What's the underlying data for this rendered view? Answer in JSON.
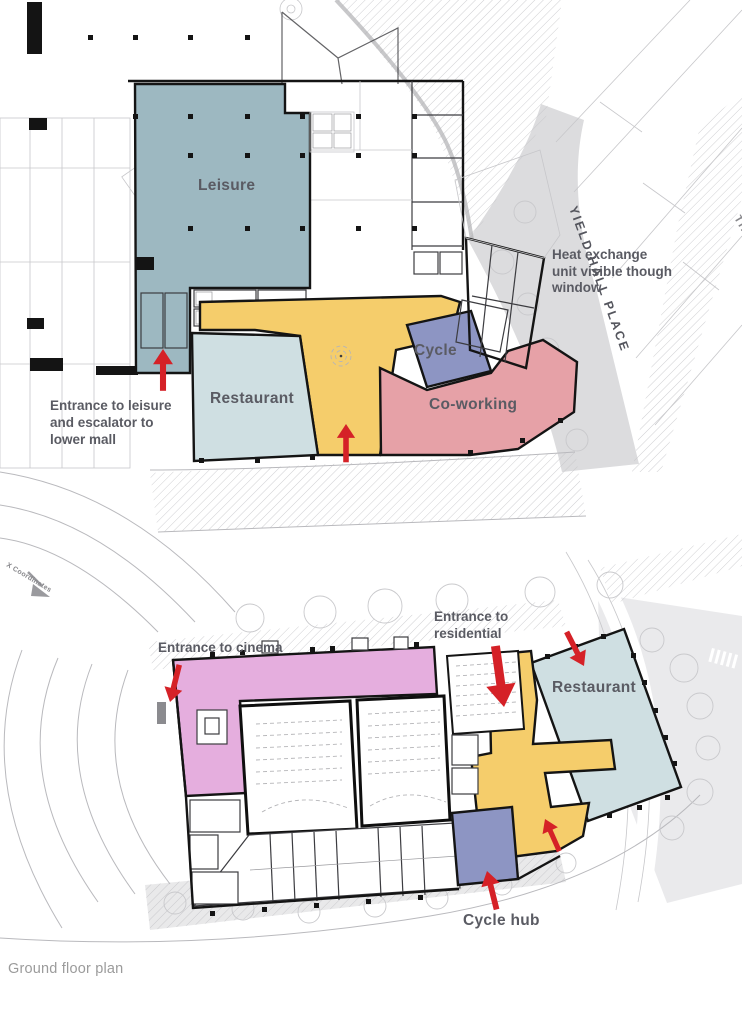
{
  "caption": "Ground floor plan",
  "colors": {
    "leisure": "#9db8c1",
    "restaurant": "#cfdfe2",
    "circulation": "#f5cd6b",
    "coworking": "#e6a1a7",
    "cycle": "#8d95c3",
    "cinema": "#e5aede",
    "arrow": "#d52127",
    "label": "#5a5b63",
    "street_label": "#54555d",
    "muted_label": "#87878b",
    "caption_label": "#9b9b9b"
  },
  "upper_plan": {
    "zone_labels": {
      "leisure": "Leisure",
      "restaurant": "Restaurant",
      "cycle": "Cycle",
      "coworking": "Co-working"
    },
    "annotations": {
      "entrance_leisure": {
        "lines": [
          "Entrance to leisure",
          "and escalator to",
          "lower mall"
        ]
      },
      "heat_exchange": {
        "lines": [
          "Heat exchange",
          "unit visible though",
          "window"
        ]
      }
    },
    "street_name": "YIELD HALL PLACE",
    "street_name_partial": "TH"
  },
  "lower_plan": {
    "zone_labels": {
      "restaurant": "Restaurant",
      "cycle_hub": "Cycle hub"
    },
    "annotations": {
      "entrance_cinema": "Entrance to cinema",
      "entrance_residential": {
        "lines": [
          "Entrance to",
          "residential"
        ]
      }
    }
  },
  "site": {
    "coordinates_label": "X Coordinates"
  }
}
